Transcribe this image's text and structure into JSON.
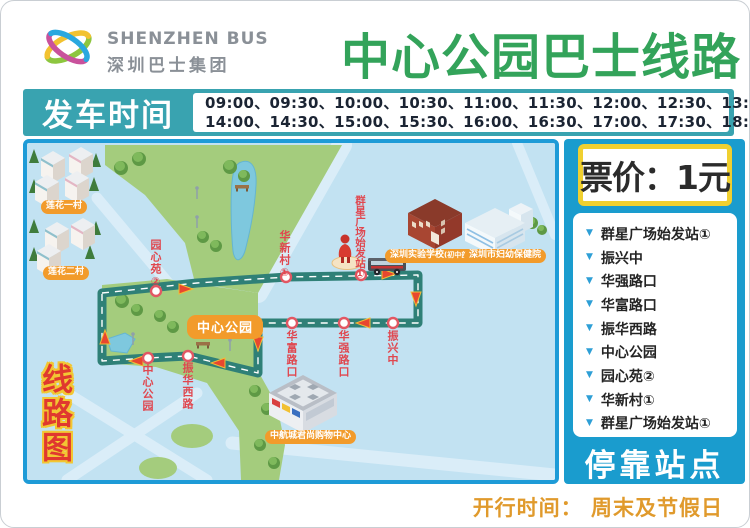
{
  "header": {
    "brand_en": "SHENZHEN BUS",
    "brand_cn": "深圳巴士集团",
    "title": "中心公园巴士线路"
  },
  "schedule": {
    "label": "发车时间",
    "times_line1": "09:00、09:30、10:00、10:30、11:00、11:30、12:00、12:30、13:00、13:30、",
    "times_line2": "14:00、14:30、15:00、15:30、16:00、16:30、17:00、17:30、18:00"
  },
  "fare": {
    "label": "票价：1元"
  },
  "stops_panel": {
    "title": "停靠站点",
    "bullet_icon": "▼",
    "stops": [
      "群星广场始发站①",
      "振兴中",
      "华强路口",
      "华富路口",
      "振华西路",
      "中心公园",
      "园心苑②",
      "华新村①",
      "群星广场始发站①"
    ]
  },
  "map": {
    "side_label": "线路图",
    "park_badge": "中心公园",
    "labels": {
      "lianhua_1": "莲花一村",
      "lianhua_2": "莲花二村",
      "yuanxinyuan": "园心苑②",
      "huaxincun": "华新村①",
      "qunxing_start": "群星广场始发站①",
      "zhenxing": "振兴中",
      "huaqiang": "华强路口",
      "huafu": "华富路口",
      "zhenhua_west": "振华西路",
      "zhongxin_park_stop": "中心公园",
      "school": "深圳实验学校",
      "school_suffix": "(初中部)",
      "hospital": "深圳市妇幼保健院",
      "mall": "中航城君尚购物中心"
    }
  },
  "footer": {
    "operating_time": "开行时间： 周末及节假日"
  },
  "colors": {
    "title_green": "#33a35a",
    "schedule_bar_teal": "#39a3b0",
    "sidebar_blue": "#1a9cce",
    "map_border_blue": "#1e9bd7",
    "map_background": "#c2e2f2",
    "route_road": "#2f8077",
    "stop_ring_red": "#e25763",
    "map_label_red": "#e0474f",
    "pill_orange": "#f29b2b",
    "fare_border_yellow": "#f0d030",
    "footer_orange": "#e09a2c",
    "park_green": "#a4cc7d"
  }
}
